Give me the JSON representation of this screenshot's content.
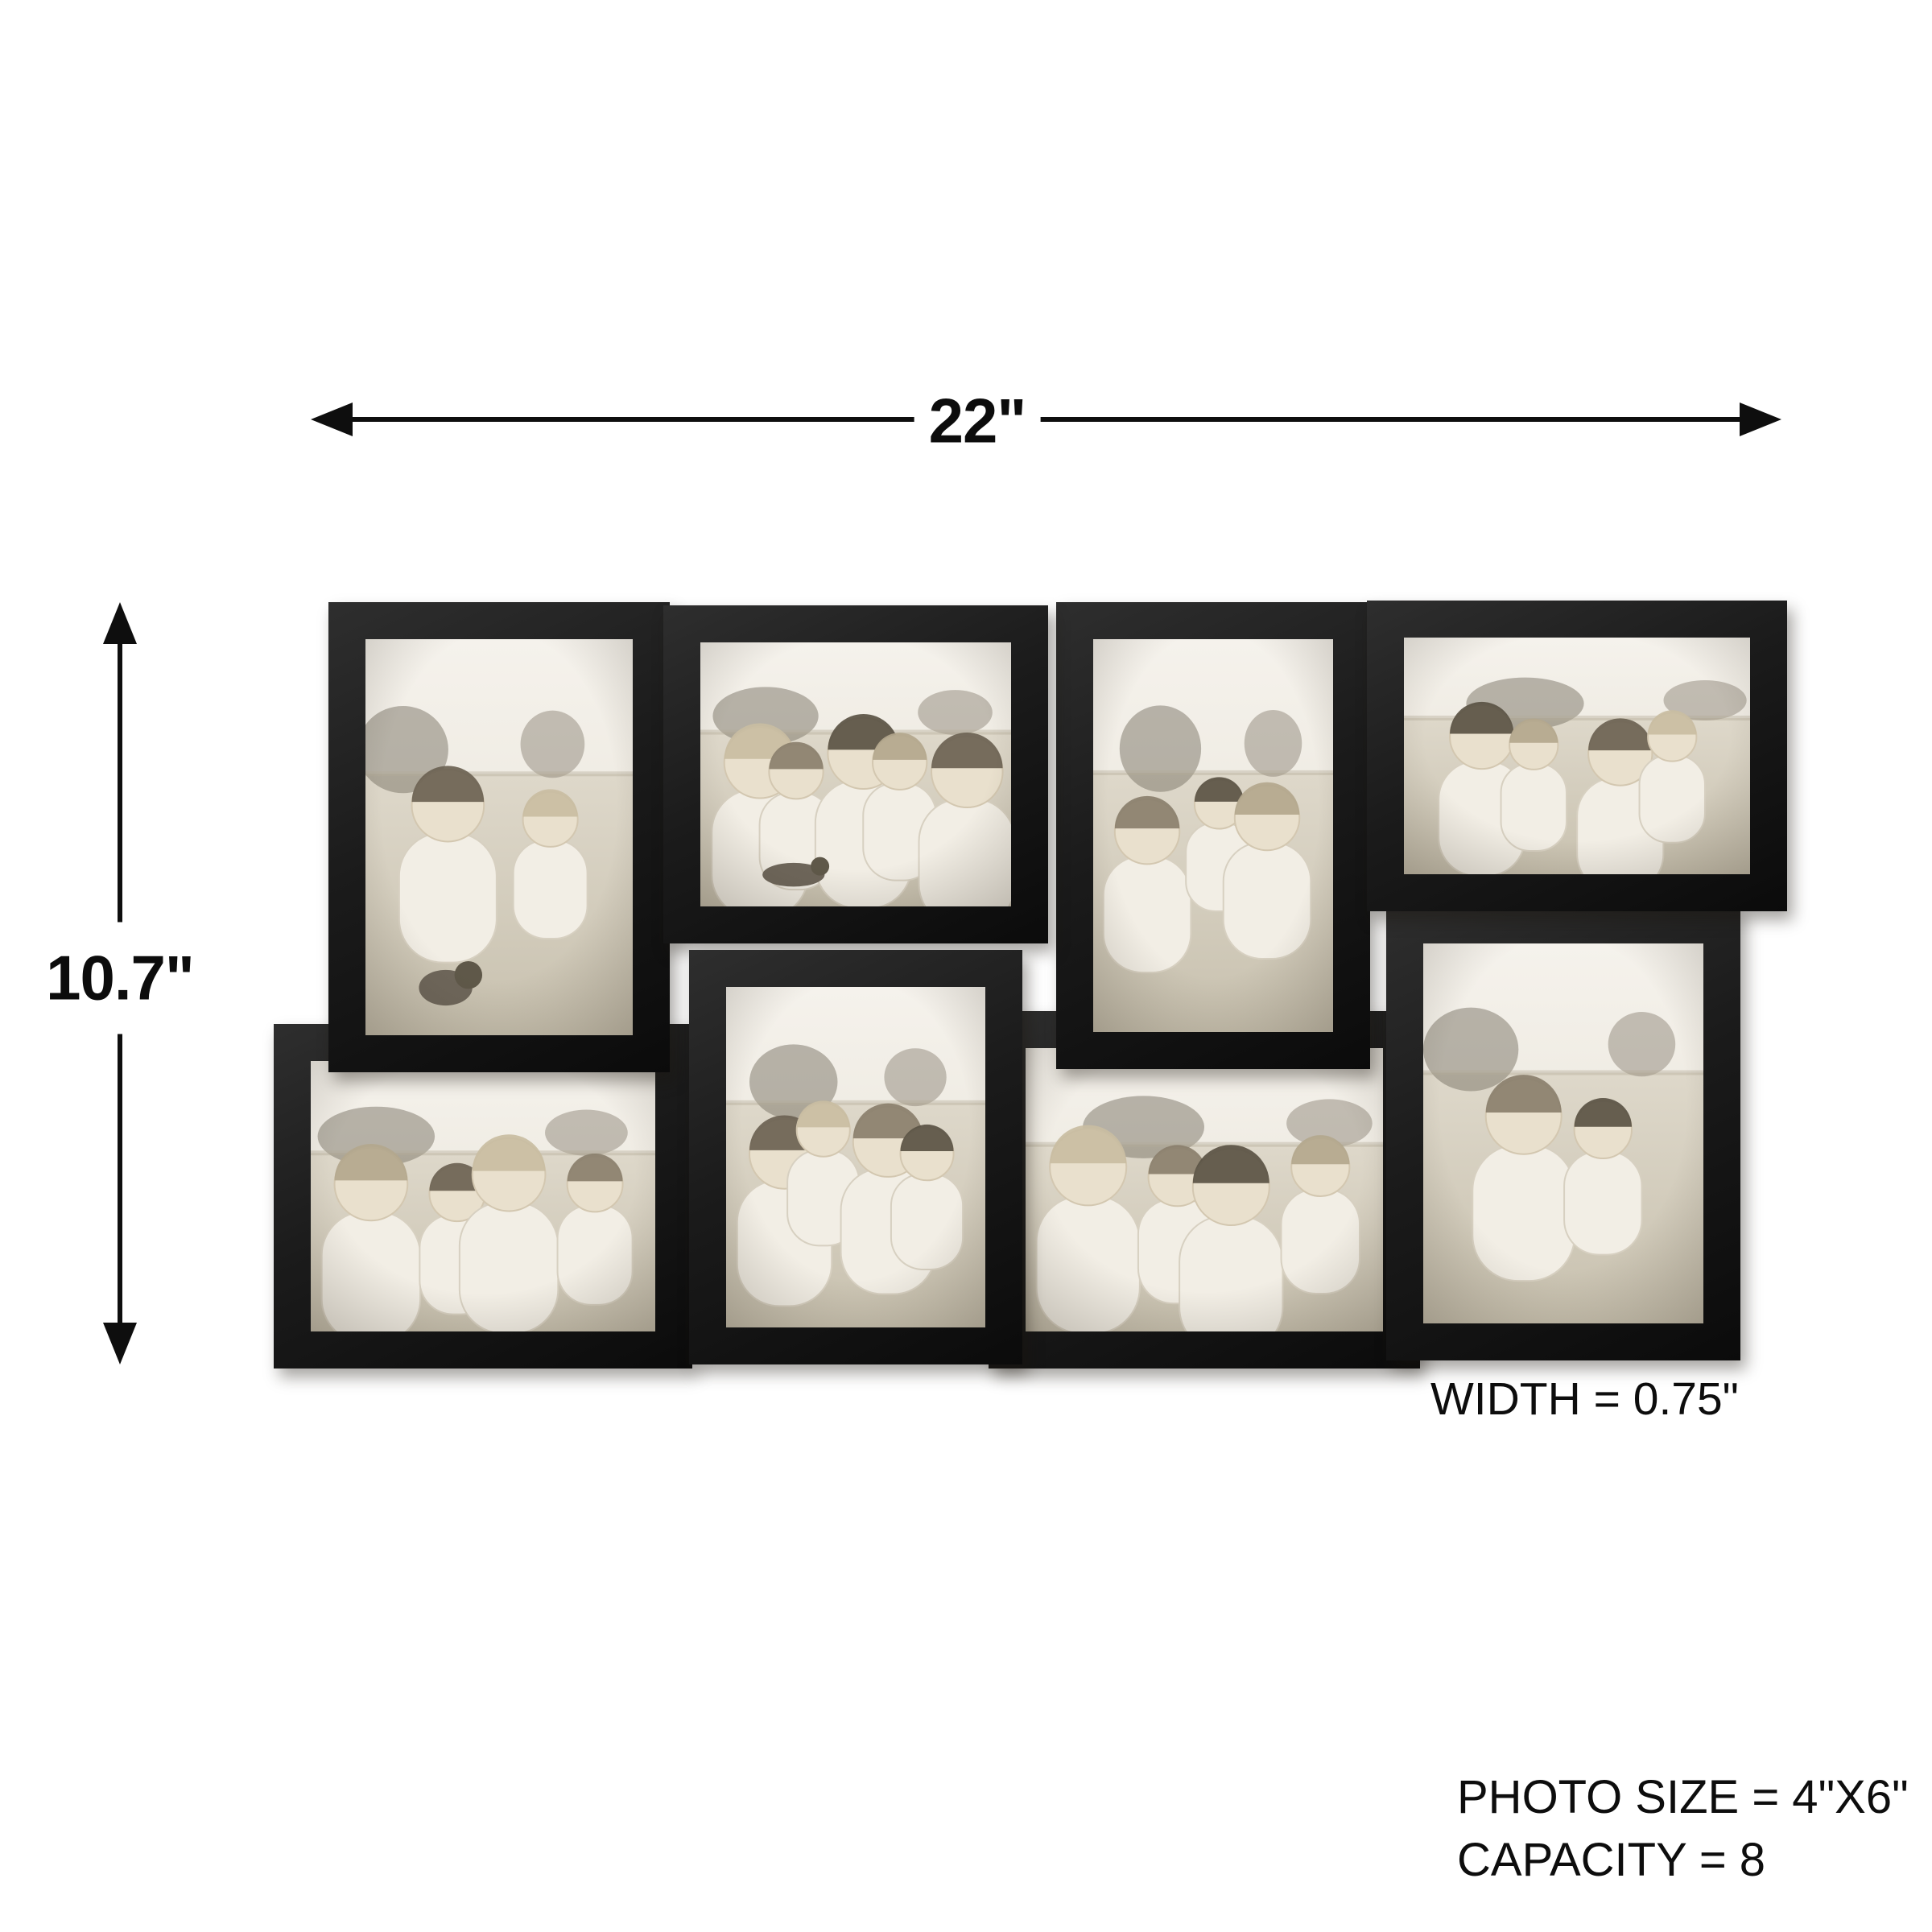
{
  "diagram": {
    "width_dimension_label": "22\"",
    "height_dimension_label": "10.7\"",
    "frame_width_note": "WIDTH = 0.75\"",
    "photo_size_spec": "PHOTO SIZE = 4\"X6\"",
    "capacity_spec": "CAPACITY = 8"
  },
  "collage": {
    "frame_color": "#1b1b1b",
    "photo_tone": "#e9e5dc",
    "photo_count": 8,
    "photos": [
      {
        "id": 1,
        "orientation": "portrait",
        "description": "father and son playing with a puppy in hay",
        "figures": 2
      },
      {
        "id": 2,
        "orientation": "landscape",
        "description": "family of five walking in a field with a dog",
        "figures": 5
      },
      {
        "id": 3,
        "orientation": "portrait",
        "description": "parents carrying child on shoulders in a field",
        "figures": 3
      },
      {
        "id": 4,
        "orientation": "landscape",
        "description": "parents with son and daughter sitting together",
        "figures": 4
      },
      {
        "id": 5,
        "orientation": "landscape",
        "description": "family of four sitting and smiling",
        "figures": 4
      },
      {
        "id": 6,
        "orientation": "portrait",
        "description": "family of four stacked portrait",
        "figures": 4
      },
      {
        "id": 7,
        "orientation": "landscape",
        "description": "family of four laughing together",
        "figures": 4
      },
      {
        "id": 8,
        "orientation": "portrait",
        "description": "father giving son a piggyback ride",
        "figures": 2
      }
    ]
  }
}
